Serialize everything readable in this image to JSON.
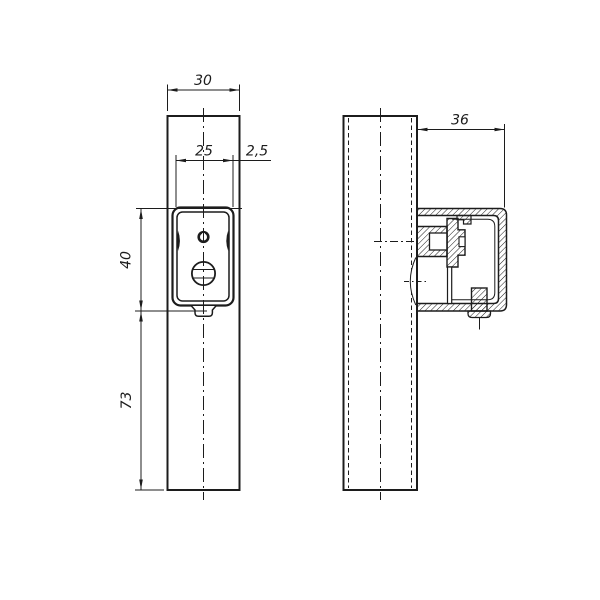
{
  "drawing": {
    "colors": {
      "ink": "#1c1c1c",
      "background": "#ffffff"
    },
    "dimensions": {
      "bar_width": "30",
      "plate_width": "25",
      "plate_edge_offset": "2,5",
      "plate_height": "40",
      "lower_length": "73",
      "housing_depth": "36"
    }
  }
}
